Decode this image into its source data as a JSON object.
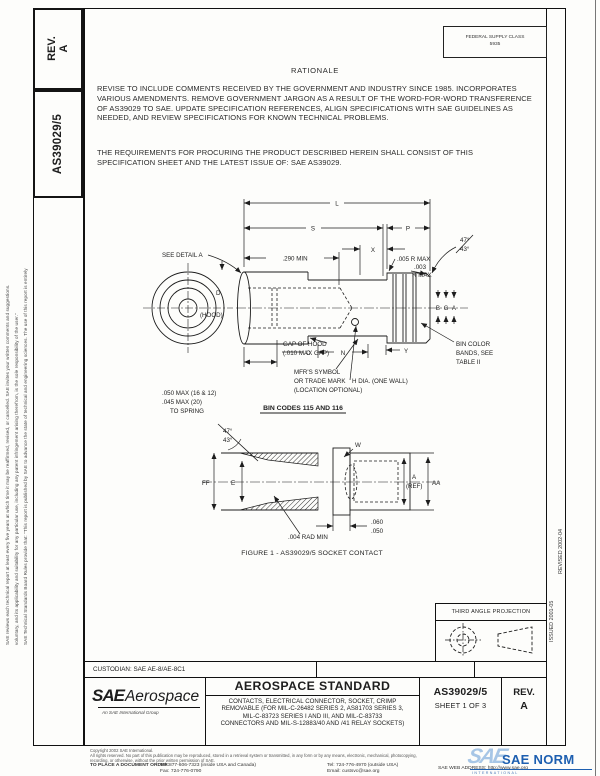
{
  "stamp": {
    "line1": "FEDERAL SUPPLY CLASS",
    "line2": "5935"
  },
  "left_margin": {
    "line1": "SAE Technical Standards Board Rules provide that: \"This report is published by SAE to advance the state of technical and engineering sciences. The use of this report is entirely",
    "line2": "voluntary, and its applicability and suitability for any particular use, including any patent infringement arising therefrom, is the sole responsibility of the user.\"",
    "line3": "SAE reviews each technical report at least every five years at which time it may be reaffirmed, revised, or cancelled. SAE invites your written comments and suggestions."
  },
  "left_tabs": {
    "rev_label": "REV.",
    "rev_value": "A",
    "doc_number": "AS39029/5"
  },
  "right_margin": {
    "issued": "ISSUED 2001-05",
    "revised": "REVISED 2002-04"
  },
  "rationale": {
    "heading": "RATIONALE",
    "body": "REVISE TO INCLUDE COMMENTS RECEIVED BY THE GOVERNMENT AND INDUSTRY SINCE 1985. INCORPORATES VARIOUS AMENDMENTS. REMOVE GOVERNMENT JARGON AS A RESULT OF THE WORD-FOR-WORD TRANSFERENCE OF AS39029 TO SAE. UPDATE SPECIFICATION REFERENCES, ALIGN SPECIFICATIONS WITH SAE GUIDELINES AS NEEDED, AND REVIEW SPECIFICATIONS FOR KNOWN TECHNICAL PROBLEMS.",
    "requirements": "THE REQUIREMENTS FOR PROCURING THE PRODUCT DESCRIBED HEREIN SHALL CONSIST OF THIS SPECIFICATION SHEET AND THE LATEST ISSUE OF: SAE AS39029."
  },
  "drawing": {
    "labels": {
      "dim_l": "L",
      "dim_s": "S",
      "dim_p": "P",
      "dim_290": ".290 MIN",
      "dim_x": "X",
      "see_detail": "SEE DETAIL A",
      "dim_d": "D",
      "hood": "(HOOD)",
      "r005": ".005 R MAX",
      "r003a": ".003",
      "r003b": "R MAX",
      "angle_top": "47°",
      "angle_bottom": "43°",
      "gap1": "GAP OF HOOD",
      "gap2": "(.010 MAX GAP)",
      "spring1": ".050 MAX (16 & 12)",
      "spring2": ".045 MAX (20)",
      "spring3": "TO SPRING",
      "mfr1": "MFR'S SYMBOL",
      "mfr2": "OR TRADE MARK",
      "mfr3": "(LOCATION OPTIONAL)",
      "h_dia": "H DIA. (ONE WALL)",
      "band_b": "B",
      "band_g": "G",
      "band_a": "A",
      "bin1": "BIN COLOR",
      "bin2": "BANDS, SEE",
      "bin3": "TABLE II",
      "dim_y": "Y",
      "dim_c": "C",
      "dim_n": "N",
      "det_angle_top": "47°",
      "det_angle_bottom": "43°",
      "dim_ff": "FF",
      "dim_e": "E",
      "rad004": ".004 RAD MIN",
      "dim_w": "W",
      "dim_a": "A",
      "dim_a_ref": "(REF)",
      "dim_aa": "AA",
      "dim_060": ".060",
      "dim_050": ".050"
    },
    "bin_codes_heading": "BIN CODES 115 AND 116",
    "figure_caption": "FIGURE 1 - AS39029/5 SOCKET CONTACT"
  },
  "projection": {
    "label": "THIRD ANGLE PROJECTION"
  },
  "custodian_label": "CUSTODIAN: SAE AE-8/AE-8C1",
  "title_block": {
    "logo_sae": "SAE",
    "logo_aerospace": "Aerospace",
    "logo_sub": "An SAE International Group",
    "standard_type": "AEROSPACE STANDARD",
    "title_lines": [
      "CONTACTS, ELECTRICAL CONNECTOR, SOCKET, CRIMP",
      "REMOVABLE (FOR MIL-C-26482 SERIES 2, AS81703 SERIES 3,",
      "MIL-C-83723 SERIES I AND III, AND MIL-C-83733",
      "CONNECTORS AND MIL-S-12883/40 AND /41 RELAY SOCKETS)"
    ],
    "doc_number": "AS39029/5",
    "sheet": "SHEET 1 OF 3",
    "rev_label": "REV.",
    "rev_value": "A"
  },
  "footer": {
    "copyright": "Copyright 2002 SAE International.",
    "rights1": "All rights reserved. No part of this publication may be reproduced, stored in a retrieval system or transmitted, in any form or by any means, electronic, mechanical, photocopying,",
    "rights2": "recording, or otherwise, without the prior written permission of SAE.",
    "order_label": "TO PLACE A DOCUMENT ORDER:",
    "tel_inside": "Tel: 877-606-7323 (inside USA and Canada)",
    "fax": "Fax: 724-776-0790",
    "tel_outside": "Tel: 724-776-4970 (outside USA)",
    "email": "Email: custsvc@sae.org",
    "web": "SAE WEB ADDRESS: http://www.sae.org"
  },
  "watermark": {
    "logo": "SAE",
    "name": "SAE NORM",
    "sub": "INTERNATIONAL"
  }
}
